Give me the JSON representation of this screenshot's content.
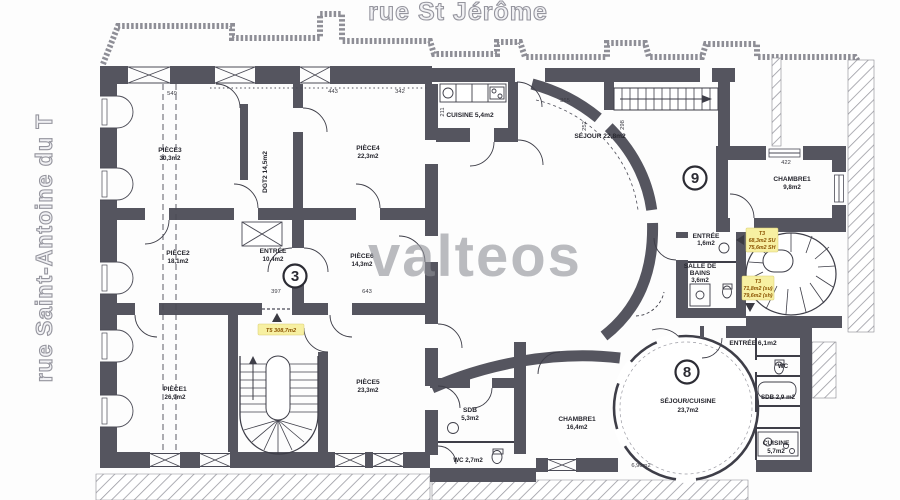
{
  "streets": {
    "top": "rue St Jérôme",
    "left": "rue Saint-Antoine du T"
  },
  "watermark": "valteos",
  "units": {
    "u3": "3",
    "u8": "8",
    "u9": "9"
  },
  "rooms": {
    "piece3": {
      "name": "PIÈCE3",
      "area": "30,3m2"
    },
    "piece4": {
      "name": "PIÈCE4",
      "area": "22,3m2"
    },
    "dgt2": {
      "label": "DGT2 14,5m2"
    },
    "piece2": {
      "name": "PIÈCE2",
      "area": "18,1m2"
    },
    "entree_u3": {
      "name": "ENTRÉE",
      "area": "10,4m2"
    },
    "piece6": {
      "name": "PIÈCE6",
      "area": "14,3m2"
    },
    "piece1": {
      "name": "PIÈCE1",
      "area": "26,9m2"
    },
    "piece5": {
      "name": "PIÈCE5",
      "area": "23,3m2"
    },
    "cuisine_top": {
      "label": "CUISINE 5,4m2"
    },
    "sejour_top": {
      "label": "SÉJOUR 22,8m2"
    },
    "chambre_u9": {
      "name": "CHAMBRE1",
      "area": "9,8m2"
    },
    "entree_u9": {
      "name": "ENTRÉE",
      "area": "1,6m2"
    },
    "sdb_u9": {
      "l1": "SALLE DE",
      "l2": "BAINS",
      "l3": "3,6m2"
    },
    "sejour_u8": {
      "name": "SÉJOUR/CUISINE",
      "area": "23,7m2"
    },
    "chambre_u8": {
      "name": "CHAMBRE1",
      "area": "16,4m2"
    },
    "entree_u8": {
      "label": "ENTRÉE 6,1m2"
    },
    "wc_u8": {
      "label": "WC"
    },
    "sdb_u8": {
      "label": "SDB 2,9 m2"
    },
    "cuisine_u8": {
      "name": "CUISINE",
      "area": "5,7m2"
    },
    "sdb_u3": {
      "name": "SDB",
      "area": "5,3m2"
    },
    "wc_u3": {
      "label": "WC 2,7m2"
    }
  },
  "tags": {
    "t5": "T5 308,7m2",
    "t3_upper": {
      "l1": "T3",
      "l2": "68,3m2 SU",
      "l3": "75,6m2 SH"
    },
    "t3_lower": {
      "l1": "T3",
      "l2": "71,8m2 (su)",
      "l3": "79,6m2 (sh)"
    }
  },
  "dims": [
    {
      "t": "549"
    },
    {
      "t": "443"
    },
    {
      "t": "342"
    },
    {
      "t": "365"
    },
    {
      "t": "422"
    },
    {
      "t": "397"
    },
    {
      "t": "643"
    },
    {
      "t": "211"
    },
    {
      "t": "252"
    },
    {
      "t": "298"
    },
    {
      "t": "6,90m2"
    }
  ],
  "colors": {
    "wall": "#55555f",
    "line": "#3e3e48",
    "highlight": "#f7f0a2",
    "tag_text": "#8a5200",
    "watermark": "#8e9097"
  }
}
